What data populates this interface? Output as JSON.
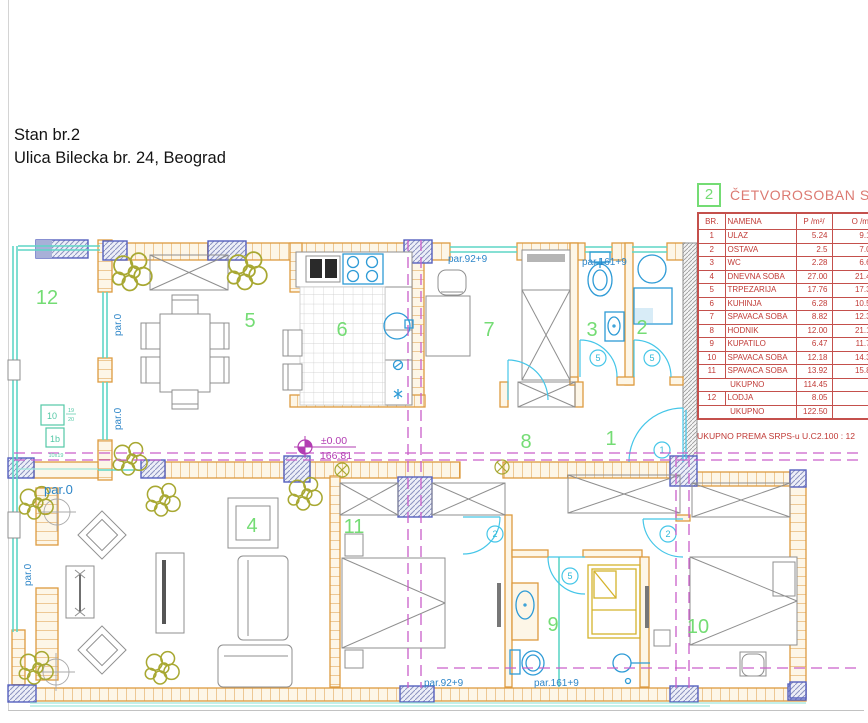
{
  "title": {
    "line1": "Stan br.2",
    "line2": "Ulica Bilecka br. 24, Beograd"
  },
  "legend": {
    "apartment_number": "2",
    "apartment_type": "ČETVOROSOBAN S",
    "columns": {
      "br": "BR.",
      "namena": "NAMENA",
      "p": "P /m²/",
      "o": "O /m¹/"
    },
    "rows": [
      {
        "br": "1",
        "namena": "ULAZ",
        "p": "5.24",
        "o": "9.19"
      },
      {
        "br": "2",
        "namena": "OSTAVA",
        "p": "2.5",
        "o": "7.00"
      },
      {
        "br": "3",
        "namena": "WC",
        "p": "2.28",
        "o": "6.62"
      },
      {
        "br": "4",
        "namena": "DNEVNA SOBA",
        "p": "27.00",
        "o": "21.41"
      },
      {
        "br": "5",
        "namena": "TRPEZARIJA",
        "p": "17.76",
        "o": "17.30"
      },
      {
        "br": "6",
        "namena": "KUHINJA",
        "p": "6.28",
        "o": "10.51"
      },
      {
        "br": "7",
        "namena": "SPAVACA SOBA",
        "p": "8.82",
        "o": "12.35"
      },
      {
        "br": "8",
        "namena": "HODNIK",
        "p": "12.00",
        "o": "21.12"
      },
      {
        "br": "9",
        "namena": "KUPATILO",
        "p": "6.47",
        "o": "11.78"
      },
      {
        "br": "10",
        "namena": "SPAVACA SOBA",
        "p": "12.18",
        "o": "14.33"
      },
      {
        "br": "11",
        "namena": "SPAVACA SOBA",
        "p": "13.92",
        "o": "15.84"
      }
    ],
    "subtotal_label": "UKUPNO",
    "subtotal_value": "114.45",
    "lodja_row": {
      "br": "12",
      "namena": "LODJA",
      "p": "8.05",
      "o": "-"
    },
    "total_label": "UKUPNO",
    "total_value": "122.50",
    "footnote": "UKUPNO PREMA SRPS-u U.C2.100 : 12"
  },
  "plan": {
    "rooms": {
      "r1": "1",
      "r2": "2",
      "r3": "3",
      "r4": "4",
      "r5": "5",
      "r6": "6",
      "r7": "7",
      "r8": "8",
      "r9": "9",
      "r10": "10",
      "r11": "11",
      "r12": "12"
    },
    "labels": {
      "par0": "par.0",
      "par92": "par.92+9",
      "par161": "par.161+9"
    },
    "level": {
      "top": "±0.00",
      "bottom": "166.81"
    },
    "refs": {
      "box_a": "10",
      "box_b": "1b",
      "frac_top": "19",
      "frac_bottom": "20",
      "size": "10x19"
    },
    "door_tags": {
      "entry": "1",
      "bedroom": "2",
      "service": "5"
    }
  },
  "colors": {
    "wall": "#DD9B40",
    "glass": "#5FD6C6",
    "room_green": "#74DC74",
    "section_magenta": "#C95FC9",
    "fixture_blue": "#2E9BD6",
    "door_cyan": "#45C6E8",
    "table_red": "#C0403C",
    "title_red": "#DC7A72",
    "plant_olive": "#A8A832"
  }
}
